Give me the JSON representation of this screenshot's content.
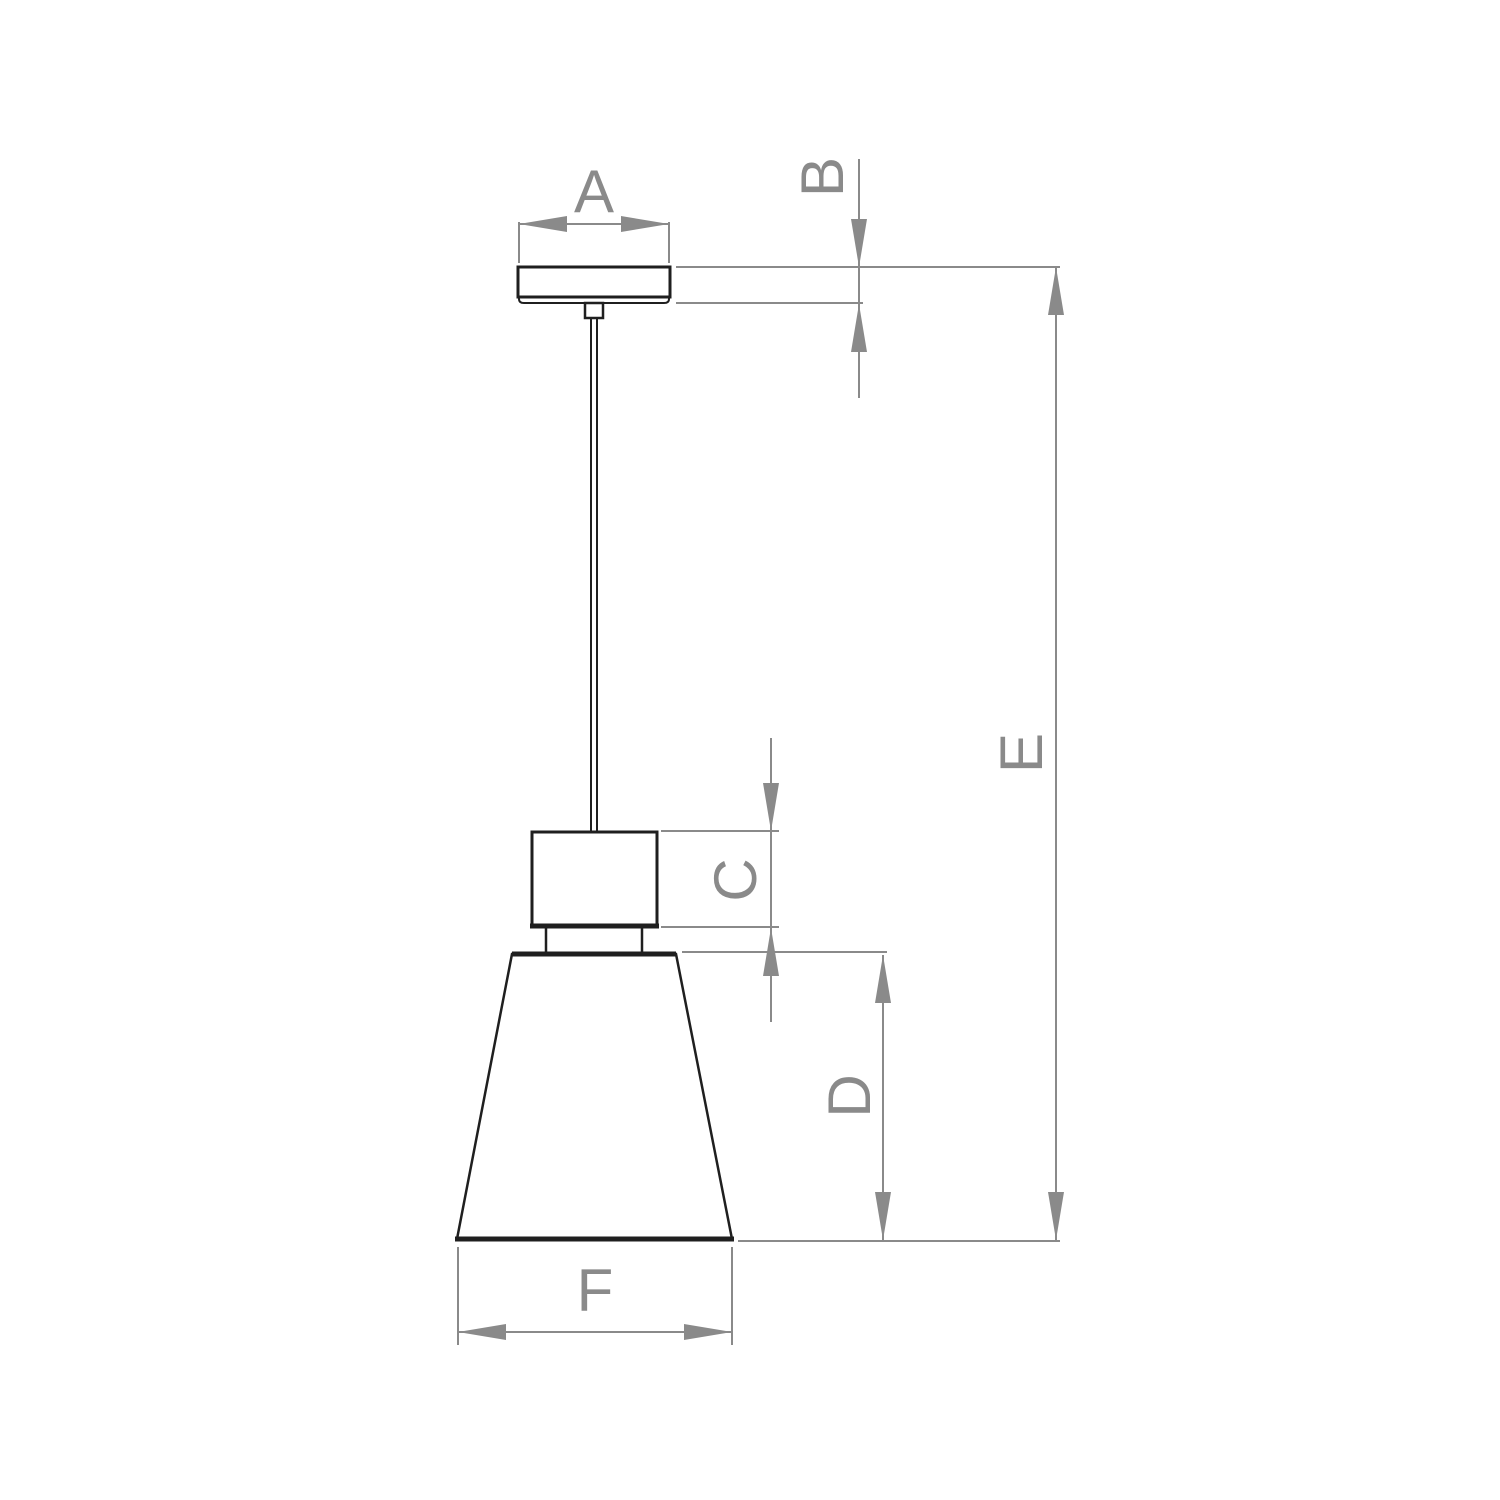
{
  "figure": {
    "kind": "technical dimension drawing",
    "labels": {
      "A": "A",
      "B": "B",
      "C": "C",
      "D": "D",
      "E": "E",
      "F": "F"
    }
  },
  "colors": {
    "background": "#ffffff",
    "drawing_outline": "#1f1f1f",
    "dimension_lines": "#8a8a8a",
    "label_text": "#8a8a8a"
  }
}
